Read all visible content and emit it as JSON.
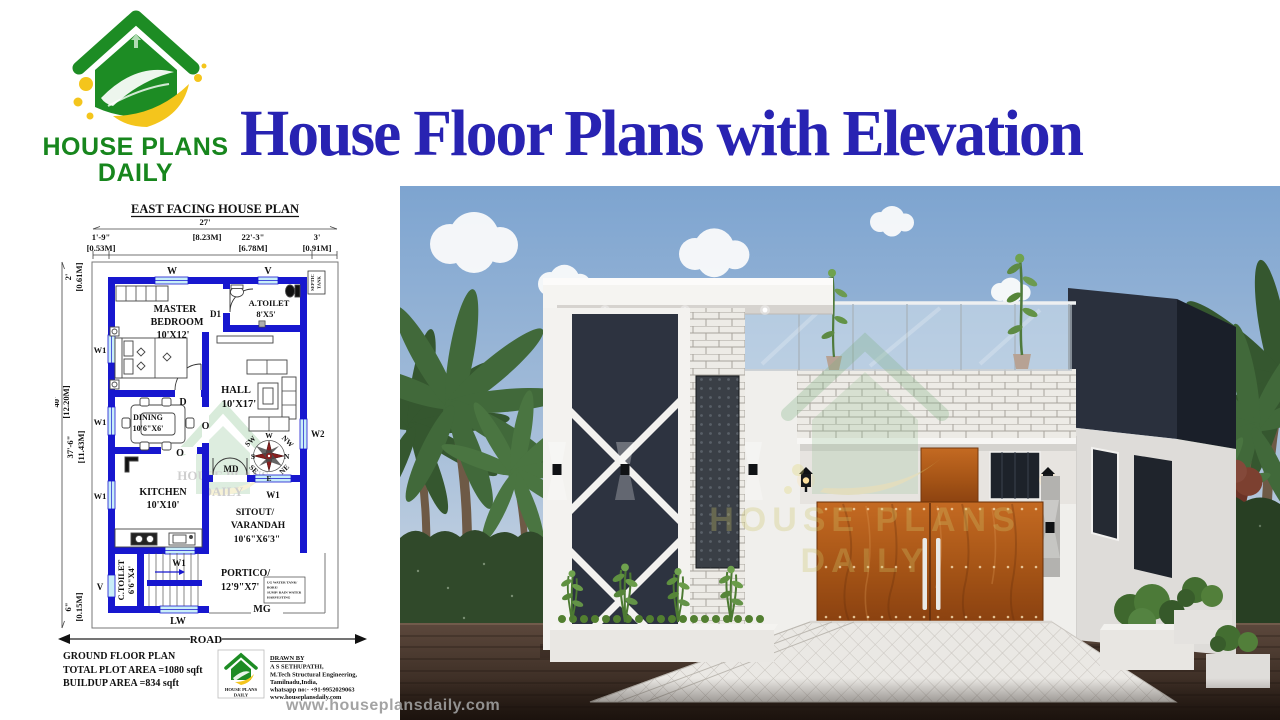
{
  "brand": {
    "line1": "HOUSE PLANS",
    "line2": "DAILY"
  },
  "title": "House Floor Plans with Elevation",
  "plan": {
    "heading": "EAST FACING HOUSE PLAN",
    "dims": {
      "top_total_ft": "27'",
      "top_total_m": "[8.23M]",
      "top_left_ft": "1'-9\"",
      "top_left_m": "[0.53M]",
      "top_mid_ft": "22'-3\"",
      "top_mid_m": "[6.78M]",
      "top_right_ft": "3'",
      "top_right_m": "[0.91M]",
      "left_top_ft": "2'",
      "left_top_m": "[0.61M]",
      "left_total_ft": "40'",
      "left_total_m": "[12.20M]",
      "left_mid_ft": "37'-6\"",
      "left_mid_m": "[11.43M]",
      "left_bottom_ft": "6\"",
      "left_bottom_m": "[0.15M]"
    },
    "rooms": {
      "master_1": "MASTER",
      "master_2": "BEDROOM",
      "master_3": "10'X12'",
      "atoilet_1": "A.TOILET",
      "atoilet_2": "8'X5'",
      "hall_1": "HALL",
      "hall_2": "10'X17'",
      "dining_1": "DINING",
      "dining_2": "10'6\"X6'",
      "kitchen_1": "KITCHEN",
      "kitchen_2": "10'X10'",
      "sitout_1": "SITOUT/",
      "sitout_2": "VARANDAH",
      "sitout_3": "10'6\"X6'3\"",
      "ctoilet_1": "C.TOILET",
      "ctoilet_2": "6'6\"X4'",
      "portico_1": "PORTICO/",
      "portico_2": "12'9\"X7'"
    },
    "labels": {
      "w": "W",
      "v": "V",
      "w1": "W1",
      "w2": "W2",
      "d": "D",
      "d1": "D1",
      "o": "O",
      "md": "MD",
      "mg": "MG",
      "lw": "LW",
      "septic_1": "SEPTIC",
      "septic_2": "TANK",
      "road": "ROAD"
    },
    "compass": {
      "n": "N",
      "s": "S",
      "e": "E",
      "w": "W",
      "ne": "NE",
      "nw": "NW",
      "se": "SE",
      "sw": "SW"
    },
    "utility_box": [
      "UG WATER TANK/",
      "BORE/",
      "SUMP/ RAIN WATER",
      "HARVESTING"
    ],
    "footer": {
      "floor": "GROUND FLOOR PLAN",
      "plot": "TOTAL PLOT AREA =1080 sqft",
      "buildup": "BUILDUP AREA =834 sqft"
    },
    "drawn_by": {
      "heading": "DRAWN BY",
      "name": "A S SETHUPATHI,",
      "degree": "M.Tech Structural Engineering,",
      "place": "Tamilnadu,India,",
      "whatsapp": "whatsapp no:- +91-9952029063",
      "website": "www.houseplansdaily.com"
    }
  },
  "watermark": {
    "url": "www.houseplansdaily.com",
    "brand_1": "HOUSE PLANS",
    "brand_2": "DAILY"
  },
  "colors": {
    "accent_blue": "#2823b2",
    "wall_blue": "#1717cf",
    "window_cyan": "#c9eef8",
    "brand_green": "#1d8c24",
    "brand_yellow": "#f4c51c",
    "compass_red": "#c31717"
  }
}
